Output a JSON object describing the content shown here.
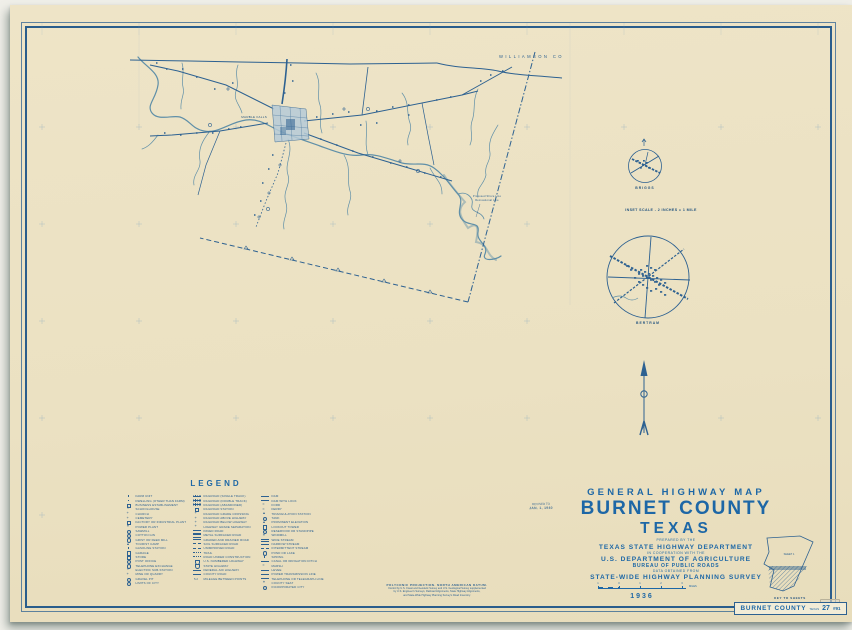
{
  "colors": {
    "paper": "#ece2c3",
    "ink": "#2d6191",
    "title_blue": "#1d67a6",
    "water": "#5f8fa8",
    "town_fill": "#b6cbd7"
  },
  "map": {
    "neighbor_county": "WILLIAMSON CO",
    "town": "MARBLE FALLS",
    "annotation": [
      "Proposed Shore Line",
      "Recreational Line"
    ]
  },
  "insets": {
    "briggs_label": "BRIGGS",
    "scale_note": "INSET SCALE - 2 INCHES = 1 MILE",
    "bertram_label": "BERTRAM"
  },
  "title_block": {
    "line1": "GENERAL HIGHWAY MAP",
    "county": "BURNET COUNTY",
    "state": "TEXAS",
    "prepared_by": "PREPARED BY THE",
    "agency1": "TEXAS STATE HIGHWAY DEPARTMENT",
    "cooperation": "IN COOPERATION WITH THE",
    "agency2": "U.S. DEPARTMENT OF AGRICULTURE",
    "bureau": "BUREAU OF PUBLIC ROADS",
    "data_note": "DATA OBTAINED FROM",
    "survey": "STATE-WIDE HIGHWAY PLANNING SURVEY",
    "year": "1936"
  },
  "revision": {
    "label": "REVISED TO",
    "date": "JAN. 1, 1940"
  },
  "scalebar": {
    "ticks": [
      "1",
      "0",
      "1",
      "2",
      "3"
    ],
    "unit": "MILES"
  },
  "legend": {
    "title": "LEGEND",
    "columns": [
      [
        {
          "g": "dot",
          "t": "FARM UNIT"
        },
        {
          "g": "dot",
          "t": "DWELLING (OTHER THAN FARM)"
        },
        {
          "g": "sq",
          "t": "BUSINESS ESTABLISHMENT"
        },
        {
          "g": "flag",
          "t": "SCHOOLHOUSE"
        },
        {
          "g": "cross",
          "t": "CHURCH"
        },
        {
          "g": "cross",
          "t": "CEMETERY"
        },
        {
          "g": "sq",
          "t": "FACTORY OR INDUSTRIAL PLANT"
        },
        {
          "g": "star",
          "t": "POWER PLANT"
        },
        {
          "g": "circ",
          "t": "SAWMILL"
        },
        {
          "g": "circ",
          "t": "COTTON GIN"
        },
        {
          "g": "circ",
          "t": "GRIST OR FEED MILL"
        },
        {
          "g": "tri",
          "t": "TOURIST CAMP"
        },
        {
          "g": "dot",
          "t": "GASOLINE STATION"
        },
        {
          "g": "sq",
          "t": "GARAGE"
        },
        {
          "g": "sq",
          "t": "STORE"
        },
        {
          "g": "circ",
          "t": "POST OFFICE"
        },
        {
          "g": "circ",
          "t": "TELEPHONE EXCHANGE"
        },
        {
          "g": "star",
          "t": "ELECTRIC SUB-STATION"
        },
        {
          "g": "cross",
          "t": "MINE OR QUARRY"
        },
        {
          "g": "circ",
          "t": "GRAVEL PIT"
        },
        {
          "g": "circ",
          "t": "LIMITS OF CITY"
        }
      ],
      [
        {
          "g": "rr",
          "t": "RAILROAD (SINGLE TRACK)"
        },
        {
          "g": "rr",
          "t": "RAILROAD (DOUBLE TRACK)"
        },
        {
          "g": "rr",
          "t": "RAILROAD (ABANDONED)"
        },
        {
          "g": "sq",
          "t": "RAILROAD STATION"
        },
        {
          "g": "cross",
          "t": "RAILROAD GRADE CROSSING"
        },
        {
          "g": "cross",
          "t": "RAILROAD ABOVE HIGHWAY"
        },
        {
          "g": "cross",
          "t": "RAILROAD BELOW HIGHWAY"
        },
        {
          "g": "cross",
          "t": "HIGHWAY GRADE SEPARATION"
        },
        {
          "g": "dbl",
          "t": "PAVED ROAD"
        },
        {
          "g": "dbl",
          "t": "METAL SURFACED ROAD"
        },
        {
          "g": "line",
          "t": "GRADED AND DRAINED ROAD"
        },
        {
          "g": "dash",
          "t": "SOIL SURFACED ROAD"
        },
        {
          "g": "dash",
          "t": "UNIMPROVED ROAD"
        },
        {
          "g": "dots",
          "t": "TRAIL"
        },
        {
          "g": "dots",
          "t": "ROAD UNDER CONSTRUCTION"
        },
        {
          "g": "shield",
          "t": "U.S. NUMBERED HIGHWAY"
        },
        {
          "g": "shield",
          "t": "STATE HIGHWAY"
        },
        {
          "g": "line",
          "t": "FEDERAL AID HIGHWAY"
        },
        {
          "g": "line",
          "t": "COUNTY ROAD"
        },
        {
          "g": "num",
          "t": "MILEAGE BETWEEN POINTS"
        }
      ],
      [
        {
          "g": "line",
          "t": "DAM"
        },
        {
          "g": "line",
          "t": "DAM WITH LOCK"
        },
        {
          "g": "wave",
          "t": "FORD"
        },
        {
          "g": "wave",
          "t": "FERRY"
        },
        {
          "g": "tri",
          "t": "TRIANGULATION STATION"
        },
        {
          "g": "circ",
          "t": "TANK"
        },
        {
          "g": "tri",
          "t": "PROMINENT ELEVATION"
        },
        {
          "g": "sq",
          "t": "LOOKOUT TOWER"
        },
        {
          "g": "circ",
          "t": "RESERVOIR OR STANDPIPE"
        },
        {
          "g": "star",
          "t": "WINDMILL"
        },
        {
          "g": "dbl",
          "t": "WIDE STREAM"
        },
        {
          "g": "line",
          "t": "NARROW STREAM"
        },
        {
          "g": "dash",
          "t": "INTERMITTENT STREAM"
        },
        {
          "g": "circ",
          "t": "POND OR LAKE"
        },
        {
          "g": "dot",
          "t": "SPRING"
        },
        {
          "g": "line",
          "t": "CANAL OR IRRIGATION DITCH"
        },
        {
          "g": "wave",
          "t": "MARSH"
        },
        {
          "g": "line",
          "t": "LEVEE"
        },
        {
          "g": "line",
          "t": "POWER TRANSMISSION LINE"
        },
        {
          "g": "line",
          "t": "TELEPHONE OR TELEGRAPH LINE"
        },
        {
          "g": "star",
          "t": "COUNTY SEAT"
        },
        {
          "g": "circ",
          "t": "INCORPORATED CITY"
        }
      ]
    ]
  },
  "key_to_sheets": {
    "sheet1": "SHEET 1",
    "caption": "KEY TO SHEETS"
  },
  "footnote": {
    "lines": [
      "POLYCONIC PROJECTION. NORTH AMERICAN DATUM.",
      "Control by U.S. Coast and Geodetic Survey and U.S. Geological Survey supplemented",
      "by U.S. Engineer's Surveys, Railroad Alignments, State Highway Alignments,",
      "and State-Wide Highway Planning Survey's Road Inventory."
    ]
  },
  "corner_label": {
    "county": "BURNET COUNTY",
    "state": "TEXAS",
    "number": "27",
    "code": "#91"
  }
}
